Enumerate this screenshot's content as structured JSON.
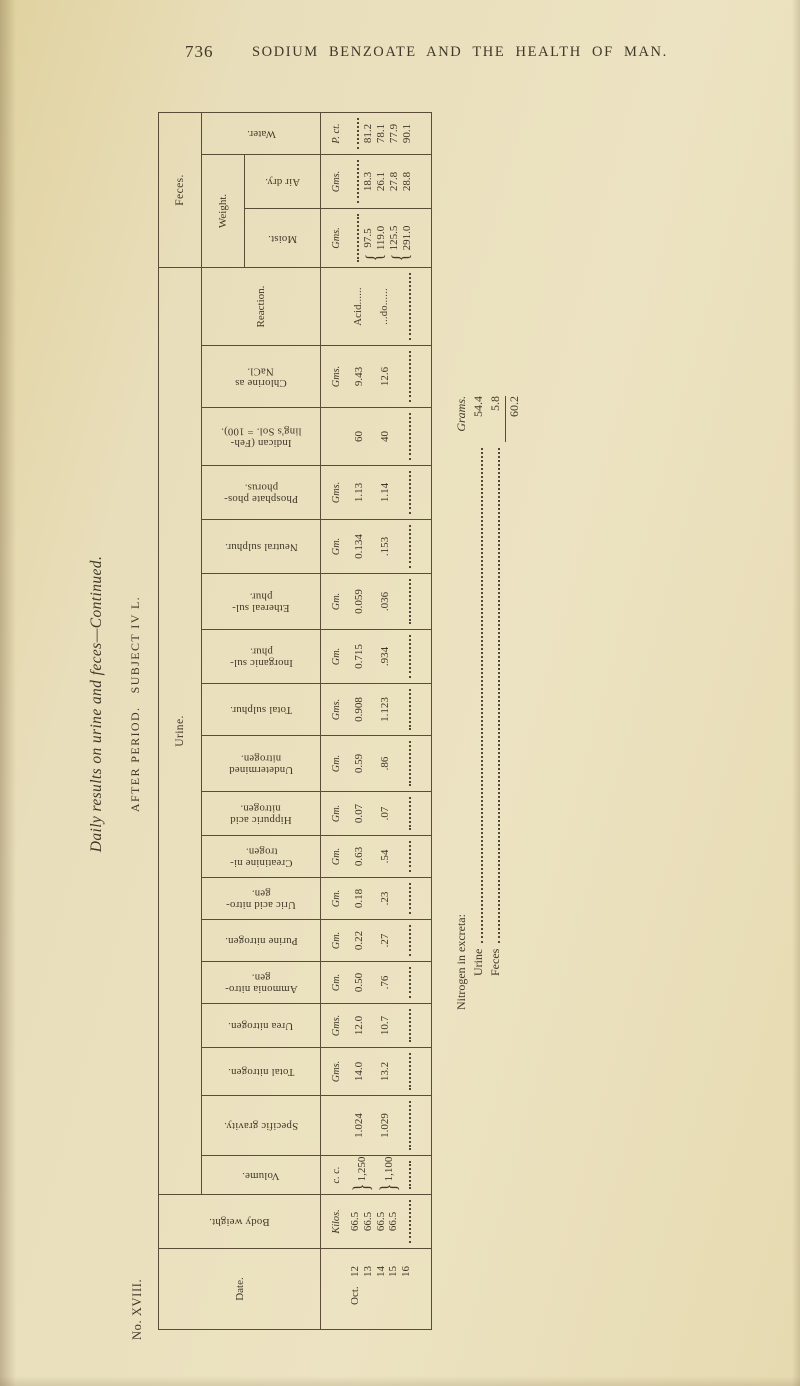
{
  "page": {
    "number": "736",
    "running_title": "SODIUM BENZOATE AND THE HEALTH OF MAN.",
    "series_label": "No. XVIII."
  },
  "caption": {
    "title": "Daily results on urine and feces—Continued.",
    "subtitle": "AFTER PERIOD.   SUBJECT IV L."
  },
  "groups": {
    "urine": "Urine.",
    "feces": "Feces.",
    "weight": "Weight."
  },
  "braces": {
    "volume": "}",
    "moist": "{"
  },
  "date_column": {
    "label": "Date.",
    "month": "Oct.",
    "days": [
      "12",
      "13",
      "14",
      "15",
      "16"
    ]
  },
  "body_weight": {
    "label": "Body weight.",
    "unit": "Kilos.",
    "values": [
      "66.5",
      "66.5",
      "66.5",
      "66.5"
    ]
  },
  "volume": {
    "label": "Volume.",
    "unit": "c. c.",
    "pooled": [
      "1,250",
      "1,100"
    ]
  },
  "urine_columns": [
    {
      "label": "Specific gravity.",
      "unit": "",
      "v1": "1.024",
      "v2": "1.029"
    },
    {
      "label": "Total nitrogen.",
      "unit": "Gms.",
      "v1": "14.0",
      "v2": "13.2"
    },
    {
      "label": "Urea nitrogen.",
      "unit": "Gms.",
      "v1": "12.0",
      "v2": "10.7"
    },
    {
      "label": "Ammonia nitro-\ngen.",
      "unit": "Gm.",
      "v1": "0.50",
      "v2": ".76"
    },
    {
      "label": "Purine nitrogen.",
      "unit": "Gm.",
      "v1": "0.22",
      "v2": ".27"
    },
    {
      "label": "Uric acid nitro-\ngen.",
      "unit": "Gm.",
      "v1": "0.18",
      "v2": ".23"
    },
    {
      "label": "Creatinine ni-\ntrogen.",
      "unit": "Gm.",
      "v1": "0.63",
      "v2": ".54"
    },
    {
      "label": "Hippuric acid\nnitrogen.",
      "unit": "Gm.",
      "v1": "0.07",
      "v2": ".07"
    },
    {
      "label": "Undetermined\nnitrogen.",
      "unit": "Gm.",
      "v1": "0.59",
      "v2": ".86"
    },
    {
      "label": "Total sulphur.",
      "unit": "Gms.",
      "v1": "0.908",
      "v2": "1.123"
    },
    {
      "label": "Inorganic sul-\nphur.",
      "unit": "Gm.",
      "v1": "0.715",
      "v2": ".934"
    },
    {
      "label": "Ethereal sul-\nphur.",
      "unit": "Gm.",
      "v1": "0.059",
      "v2": ".036"
    },
    {
      "label": "Neutral sulphur.",
      "unit": "Gm.",
      "v1": "0.134",
      "v2": ".153"
    },
    {
      "label": "Phosphate phos-\nphorus.",
      "unit": "Gms.",
      "v1": "1.13",
      "v2": "1.14"
    },
    {
      "label": "Indican (Feh-\nling's Sol. = 100).",
      "unit": "",
      "v1": "60",
      "v2": "40"
    },
    {
      "label": "Chlorine as\nNaCl.",
      "unit": "Gms.",
      "v1": "9.43",
      "v2": "12.6"
    }
  ],
  "reaction": {
    "label": "Reaction.",
    "v1": "Acid......",
    "v2": "...do......"
  },
  "feces": {
    "weight_columns": [
      {
        "label": "Moist.",
        "unit": "Gms.",
        "braced": true,
        "values": [
          "97.5",
          "119.0",
          "125.5",
          "291.0"
        ]
      },
      {
        "label": "Air dry.",
        "unit": "Gms.",
        "braced": false,
        "values": [
          "18.3",
          "26.1",
          "27.8",
          "28.8"
        ]
      }
    ],
    "water": {
      "label": "Water.",
      "unit": "P. ct.",
      "values": [
        "81.2",
        "78.1",
        "77.9",
        "90.1"
      ]
    }
  },
  "summary": {
    "heading": "Nitrogen in excreta:",
    "unit_heading": "Grams.",
    "rows": [
      {
        "label": "Urine",
        "value": "54.4"
      },
      {
        "label": "Feces",
        "value": "5.8"
      }
    ],
    "total": "60.2"
  }
}
